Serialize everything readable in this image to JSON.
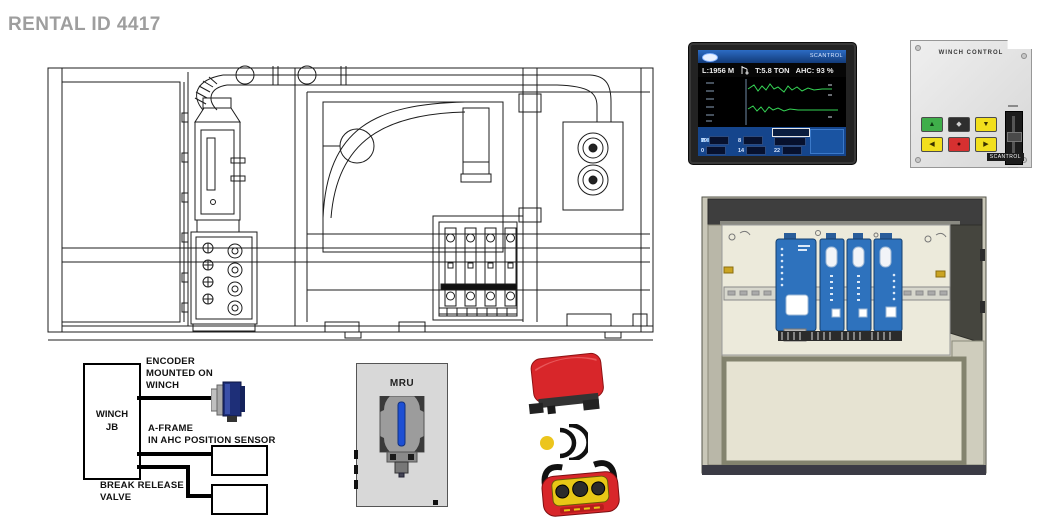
{
  "page": {
    "title": "RENTAL ID 4417"
  },
  "hmi": {
    "brand": "SCANTROL",
    "readouts": {
      "depth": "L:1956 M",
      "tension": "T:5.8 TON",
      "ahc": "AHC: 93 %"
    },
    "fields": {
      "a": "79",
      "b": "8",
      "c": "0",
      "d": "14",
      "e": "22"
    },
    "colors": {
      "panel_blue": "#15458c",
      "trace_green": "#35d455",
      "screen_black": "#000000"
    }
  },
  "control_panel": {
    "title": "WINCH CONTROL",
    "logo": "SCANTROL",
    "buttons": [
      {
        "id": "green-button",
        "color": "#3fae4a"
      },
      {
        "id": "black-function-button",
        "color": "#2e2e2e"
      },
      {
        "id": "yellow-down-button",
        "color": "#f2df1d"
      },
      {
        "id": "yellow-left-button",
        "color": "#f2df1d"
      },
      {
        "id": "red-stop-button",
        "color": "#d63030"
      },
      {
        "id": "yellow-right-button",
        "color": "#f2df1d"
      }
    ]
  },
  "cabinet": {
    "module_count": 4,
    "module_color": "#2e72bd",
    "body_color": "#e6e3d2"
  },
  "wiring": {
    "jb_label": "WINCH\nJB",
    "encoder_label": "ENCODER\nMOUNTED ON\nWINCH",
    "aframe_label": "A-FRAME\nIN AHC POSITION SENSOR",
    "brake_label": "BREAK RELEASE\nVALVE"
  },
  "mru": {
    "label": "MRU"
  },
  "radio": {
    "receiver_color": "#d8262a",
    "remote_color": "#d8262a",
    "signal_color": "#ecc51c"
  }
}
